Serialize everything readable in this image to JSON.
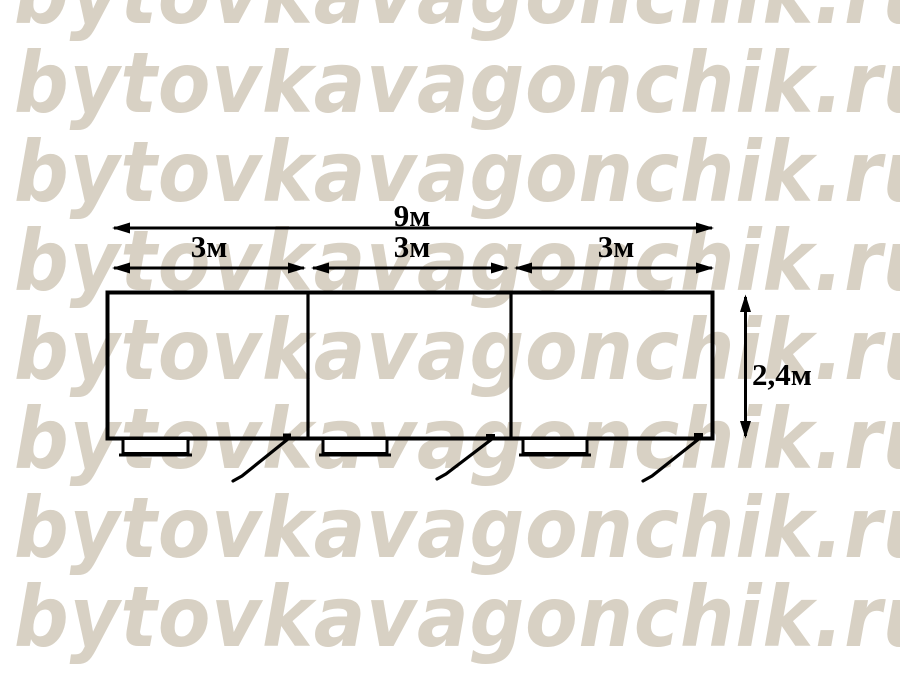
{
  "watermark": {
    "text": "bytovkavagonchik.ru",
    "color": "#d8d1c4",
    "row_count": 8
  },
  "diagram": {
    "type": "modular-cabin-plan",
    "line_color": "#000000",
    "module_count": 3,
    "labels": {
      "total_width": "9м",
      "sections": [
        "3м",
        "3м",
        "3м"
      ],
      "height": "2,4м"
    }
  }
}
